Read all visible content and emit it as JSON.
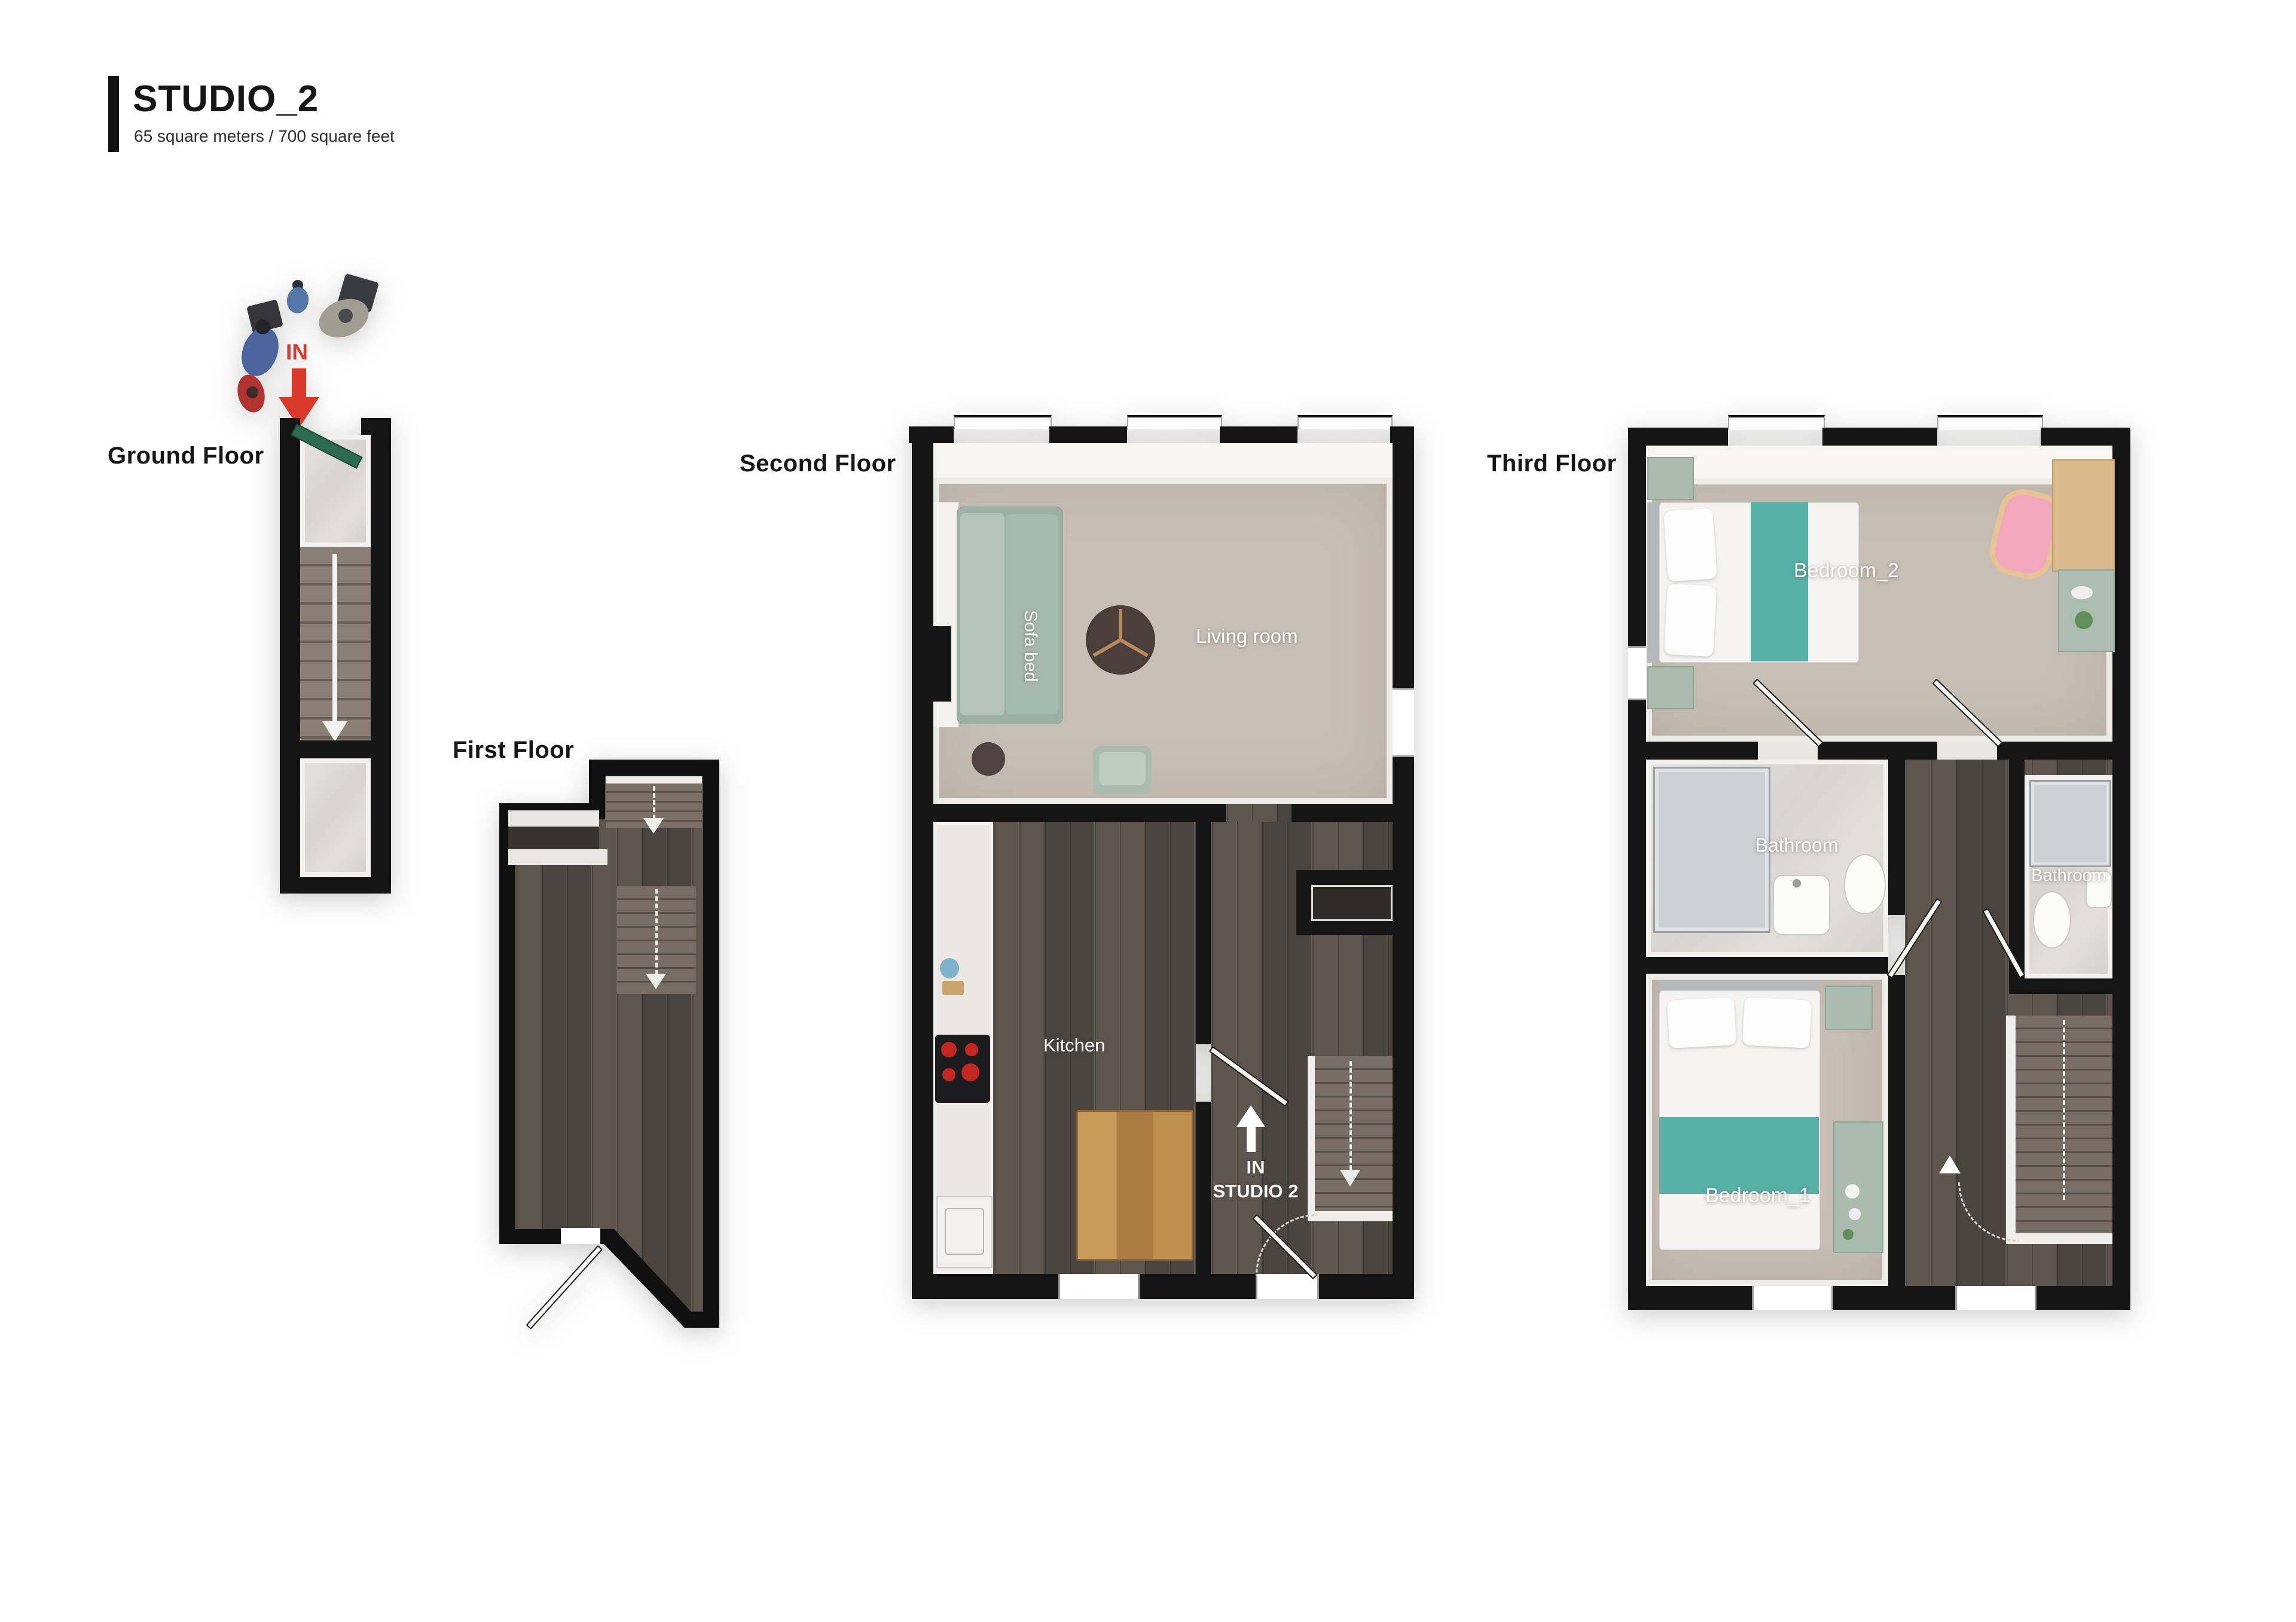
{
  "page": {
    "background": "#ffffff"
  },
  "title": {
    "name": "STUDIO_2",
    "area": "65 square meters / 700 square feet"
  },
  "floors": {
    "ground": {
      "label": "Ground Floor",
      "entry": {
        "text": "IN"
      }
    },
    "first": {
      "label": "First Floor"
    },
    "second": {
      "label": "Second Floor",
      "rooms": {
        "sofa_bed": "Sofa bed",
        "living": "Living room",
        "kitchen": "Kitchen"
      },
      "entry": {
        "line1": "IN",
        "line2": "STUDIO 2"
      }
    },
    "third": {
      "label": "Third Floor",
      "rooms": {
        "bedroom2": "Bedroom_2",
        "bathroom_left": "Bathroom",
        "bathroom_right": "Bathroom",
        "bedroom1": "Bedroom_1"
      }
    }
  },
  "colors": {
    "wall": "#141414",
    "accent_red": "#d93a2b",
    "teal_bed_runner": "#58b1a6",
    "sage_furniture": "#a9bcae",
    "carpet": "#c7beb5",
    "dark_wood": "#57504a",
    "oak_table": "#b9854a",
    "marble": "#dcd9d5",
    "pink_baby_bath": "#f2a7bd",
    "green_entry_door": "#2c6b50"
  }
}
